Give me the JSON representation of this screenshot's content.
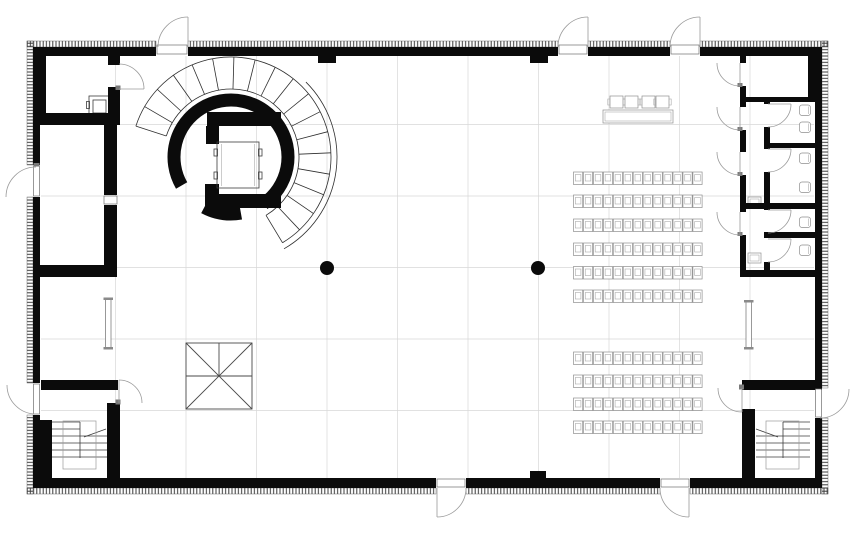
{
  "canvas": {
    "width": 860,
    "height": 545,
    "background": "#ffffff"
  },
  "colors": {
    "wall": "#0b0b0b",
    "line": "#3c3c3c",
    "furniture": "#8f8f8f",
    "door_arc": "#9a9a9a",
    "grid": "#d7d7d7",
    "threshold": "#6e6e6e",
    "hatch": "#3a3a3a"
  },
  "plan": {
    "grid": {
      "vertical_x": [
        115.5,
        186,
        256.5,
        327,
        397.5,
        468,
        538.5,
        609,
        679.5,
        750
      ],
      "v_y0": 56,
      "v_y1": 478,
      "horizontal_y": [
        124.5,
        196,
        267.5,
        339,
        410.5
      ],
      "h_x0": 41,
      "h_x1": 814
    },
    "hatch_bands": {
      "horizontal": [
        [
          27,
          41,
          129,
          6
        ],
        [
          188,
          41,
          370,
          6
        ],
        [
          588,
          41,
          82,
          6
        ],
        [
          700,
          41,
          128,
          6
        ],
        [
          27,
          488,
          409,
          6
        ],
        [
          466,
          488,
          194,
          6
        ],
        [
          690,
          488,
          138,
          6
        ]
      ],
      "vertical": [
        [
          27,
          41,
          6,
          124
        ],
        [
          27,
          197,
          6,
          186
        ],
        [
          27,
          415,
          6,
          79
        ],
        [
          822,
          41,
          6,
          347
        ],
        [
          822,
          418,
          6,
          76
        ]
      ]
    },
    "walls": [
      [
        33,
        47,
        123,
        9
      ],
      [
        188,
        47,
        370,
        9
      ],
      [
        588,
        47,
        82,
        9
      ],
      [
        700,
        47,
        122,
        9
      ],
      [
        33,
        478,
        403,
        10
      ],
      [
        466,
        478,
        194,
        10
      ],
      [
        690,
        478,
        132,
        10
      ],
      [
        33,
        47,
        7,
        118
      ],
      [
        33,
        197,
        7,
        186
      ],
      [
        33,
        415,
        7,
        63
      ],
      [
        815,
        47,
        7,
        341
      ],
      [
        815,
        418,
        7,
        60
      ],
      [
        318,
        56,
        18,
        7
      ],
      [
        530,
        56,
        18,
        7
      ],
      [
        530,
        471,
        16,
        7
      ],
      [
        40,
        56,
        6,
        57
      ],
      [
        108,
        56,
        12,
        9
      ],
      [
        108,
        87,
        12,
        26
      ],
      [
        40,
        113,
        80,
        12
      ],
      [
        104,
        125,
        13,
        70
      ],
      [
        104,
        205,
        13,
        72
      ],
      [
        40,
        265,
        77,
        12
      ],
      [
        740,
        56,
        6,
        7
      ],
      [
        740,
        86,
        6,
        21
      ],
      [
        740,
        130,
        6,
        22
      ],
      [
        740,
        175,
        6,
        37
      ],
      [
        740,
        235,
        6,
        42
      ],
      [
        808,
        56,
        14,
        46
      ],
      [
        746,
        97,
        69,
        5
      ],
      [
        764,
        143,
        51,
        5
      ],
      [
        746,
        203,
        69,
        6
      ],
      [
        764,
        232,
        51,
        6
      ],
      [
        740,
        270,
        75,
        7
      ],
      [
        764,
        97,
        6,
        7
      ],
      [
        764,
        127,
        6,
        22
      ],
      [
        764,
        172,
        6,
        38
      ],
      [
        764,
        262,
        6,
        8
      ],
      [
        41,
        380,
        77,
        10
      ],
      [
        107,
        403,
        13,
        75
      ],
      [
        40,
        420,
        12,
        58
      ],
      [
        742,
        380,
        80,
        10
      ],
      [
        742,
        409,
        13,
        69
      ]
    ],
    "thresholds": [
      [
        157,
        45,
        30,
        9
      ],
      [
        559,
        45,
        28,
        9
      ],
      [
        671,
        45,
        28,
        9
      ],
      [
        437,
        479,
        28,
        8
      ],
      [
        661,
        479,
        28,
        8
      ],
      [
        33.5,
        166,
        6,
        30
      ],
      [
        33.5,
        384,
        6,
        30
      ],
      [
        815.5,
        389,
        6,
        28
      ],
      [
        104,
        196,
        13,
        8
      ]
    ],
    "hinges": [
      [
        115.5,
        85.5,
        5,
        4.5
      ],
      [
        115.5,
        399.5,
        5,
        5
      ],
      [
        739,
        384.5,
        5,
        5
      ],
      [
        737.5,
        83,
        5,
        4
      ],
      [
        737.5,
        127,
        5,
        4
      ],
      [
        737.5,
        172,
        5,
        4
      ],
      [
        737.5,
        232,
        5,
        4
      ],
      [
        33.5,
        163,
        6,
        3.5
      ]
    ],
    "doors": [
      {
        "hinge": [
          188,
          47
        ],
        "r": 30,
        "a0": 180,
        "a1": 270,
        "leaf": "end",
        "name": "entrance-door-top-left"
      },
      {
        "hinge": [
          588,
          47
        ],
        "r": 30,
        "a0": 180,
        "a1": 270,
        "leaf": "end",
        "name": "entrance-door-top-middle"
      },
      {
        "hinge": [
          700,
          47
        ],
        "r": 30,
        "a0": 180,
        "a1": 270,
        "leaf": "end",
        "name": "entrance-door-top-right"
      },
      {
        "hinge": [
          437,
          488
        ],
        "r": 29,
        "a0": 0,
        "a1": 90,
        "leaf": "end",
        "name": "entrance-door-bottom-left"
      },
      {
        "hinge": [
          689,
          488
        ],
        "r": 29,
        "a0": 90,
        "a1": 180,
        "leaf": "start",
        "name": "entrance-door-bottom-right"
      },
      {
        "hinge": [
          36,
          197
        ],
        "r": 30,
        "a0": 270,
        "a1": 180,
        "leaf": null,
        "name": "exterior-door-left-room"
      },
      {
        "hinge": [
          36,
          385
        ],
        "r": 29,
        "a0": 90,
        "a1": 180,
        "leaf": null,
        "name": "exterior-door-stair-left"
      },
      {
        "hinge": [
          820,
          389
        ],
        "r": 29,
        "a0": 0,
        "a1": 90,
        "leaf": null,
        "name": "exterior-door-stair-right"
      },
      {
        "hinge": [
          119,
          403
        ],
        "r": 23,
        "a0": 270,
        "a1": 360,
        "leaf": "start",
        "name": "stair-left-hall-door"
      },
      {
        "hinge": [
          742,
          388
        ],
        "r": 24,
        "a0": 90,
        "a1": 180,
        "leaf": "start",
        "name": "stair-right-hall-door"
      },
      {
        "hinge": [
          119,
          89
        ],
        "r": 25,
        "a0": 270,
        "a1": 360,
        "leaf": "end",
        "name": "storeroom-door"
      },
      {
        "hinge": [
          740,
          63
        ],
        "r": 23,
        "a0": 90,
        "a1": 180,
        "leaf": "start",
        "name": "wc-hall-door-1"
      },
      {
        "hinge": [
          740,
          107
        ],
        "r": 23,
        "a0": 90,
        "a1": 180,
        "leaf": "start",
        "name": "wc-hall-door-2"
      },
      {
        "hinge": [
          740,
          152
        ],
        "r": 23,
        "a0": 90,
        "a1": 180,
        "leaf": "start",
        "name": "wc-hall-door-3"
      },
      {
        "hinge": [
          740,
          212
        ],
        "r": 23,
        "a0": 90,
        "a1": 180,
        "leaf": "start",
        "name": "wc-hall-door-4"
      },
      {
        "hinge": [
          768,
          104
        ],
        "r": 23,
        "a0": 0,
        "a1": 90,
        "leaf": "start",
        "name": "wc-stall-door-1"
      },
      {
        "hinge": [
          768,
          149
        ],
        "r": 23,
        "a0": 0,
        "a1": 90,
        "leaf": "start",
        "name": "wc-stall-door-2"
      },
      {
        "hinge": [
          768,
          210
        ],
        "r": 23,
        "a0": 0,
        "a1": 90,
        "leaf": "start",
        "name": "wc-stall-door-3"
      },
      {
        "hinge": [
          768,
          239
        ],
        "r": 23,
        "a0": 0,
        "a1": 90,
        "leaf": "start",
        "name": "wc-stall-door-4"
      }
    ],
    "stair_lines": [
      [
        80,
        422,
        80,
        458
      ],
      [
        52,
        422,
        80,
        422
      ],
      [
        52,
        429,
        80,
        429
      ],
      [
        52,
        436,
        80,
        436
      ],
      [
        52,
        443,
        80,
        443
      ],
      [
        52,
        450,
        80,
        450
      ],
      [
        52,
        457,
        80,
        457
      ],
      [
        80,
        436,
        107,
        436
      ],
      [
        80,
        443,
        107,
        443
      ],
      [
        80,
        450,
        107,
        450
      ],
      [
        80,
        457,
        107,
        457
      ],
      [
        84,
        437,
        106,
        429
      ],
      [
        783,
        422,
        783,
        458
      ],
      [
        783,
        422,
        810,
        422
      ],
      [
        783,
        429,
        810,
        429
      ],
      [
        783,
        436,
        810,
        436
      ],
      [
        783,
        443,
        810,
        443
      ],
      [
        783,
        450,
        810,
        450
      ],
      [
        783,
        457,
        810,
        457
      ],
      [
        756,
        436,
        783,
        436
      ],
      [
        756,
        443,
        783,
        443
      ],
      [
        756,
        450,
        783,
        450
      ],
      [
        756,
        457,
        783,
        457
      ],
      [
        756,
        429,
        778,
        437
      ]
    ],
    "stair_rails": [
      [
        63,
        421,
        33,
        48
      ],
      [
        766,
        421,
        33,
        48
      ]
    ],
    "skylight": {
      "rect": [
        186,
        343,
        66,
        66
      ],
      "lines": [
        [
          186,
          343,
          252,
          409
        ],
        [
          252,
          343,
          186,
          409
        ],
        [
          186,
          376,
          252,
          376
        ],
        [
          219,
          343,
          219,
          376
        ]
      ]
    },
    "columns": {
      "r": 7,
      "centers": [
        [
          327,
          268
        ],
        [
          538,
          268
        ]
      ]
    },
    "screens": {
      "rects": [
        [
          105.5,
          299,
          5.5,
          49
        ],
        [
          746,
          302,
          5.5,
          46
        ]
      ],
      "caps": [
        [
          103.5,
          297.5,
          9.5,
          2.5
        ],
        [
          103.5,
          347,
          9.5,
          2.5
        ],
        [
          744,
          300,
          9.5,
          2.5
        ],
        [
          744,
          347,
          9.5,
          2.5
        ]
      ]
    },
    "spiral_stair": {
      "center": [
        231,
        157
      ],
      "ring": {
        "radius": 57,
        "width": 13,
        "arcs": [
          [
            150,
            415
          ],
          [
            80,
            118
          ]
        ]
      },
      "steps": {
        "r_inner": 68,
        "r_outer": 100,
        "a0": 198,
        "a1": 419,
        "count": 18
      },
      "edge_arcs": [
        [
          100,
          198,
          419
        ],
        [
          106,
          315,
          420
        ],
        [
          68,
          198,
          419
        ]
      ]
    },
    "elevator": {
      "bars": [
        [
          207,
          112,
          74,
          14
        ],
        [
          205,
          194,
          76,
          14
        ],
        [
          206,
          126,
          13,
          18
        ],
        [
          205,
          184,
          14,
          10
        ]
      ],
      "car": [
        217,
        142,
        42,
        46
      ],
      "car_lines": [
        [
          221.5,
          144,
          221.5,
          186
        ],
        [
          254.5,
          144,
          254.5,
          186
        ]
      ],
      "ticks": [
        [
          214,
          149,
          3.5,
          7
        ],
        [
          214,
          172,
          3.5,
          7
        ],
        [
          258.5,
          149,
          3.5,
          7
        ],
        [
          258.5,
          172,
          3.5,
          7
        ]
      ]
    },
    "dumbwaiter": {
      "rects": [
        [
          89,
          96,
          21,
          21
        ],
        [
          93,
          100,
          13,
          13
        ]
      ],
      "ticks": [
        [
          86.5,
          101.5,
          3,
          7
        ],
        [
          109.5,
          101.5,
          3,
          7
        ]
      ]
    },
    "toilets": {
      "wc_x": 799.5,
      "wc_w": 11,
      "wc_h": 10.5,
      "wc_y": [
        105,
        122,
        153,
        182,
        217,
        245
      ],
      "sinks": [
        [
          748,
          197,
          13,
          10
        ],
        [
          748,
          253,
          13,
          10
        ]
      ]
    },
    "seating": {
      "rows": {
        "x0": 573.5,
        "pitch": 9.95,
        "seat_w": 9.2,
        "seat_h": 12.5,
        "per_row": 13,
        "ys": [
          172,
          195,
          219,
          243,
          266.5,
          290,
          352,
          375,
          398,
          421
        ]
      },
      "head_chairs": {
        "xs": [
          610,
          625,
          642,
          656
        ],
        "y": 96,
        "w": 13,
        "h": 12
      },
      "table": {
        "outer": [
          603,
          110,
          70,
          13
        ],
        "inner": [
          605,
          112,
          66,
          9
        ]
      }
    }
  }
}
